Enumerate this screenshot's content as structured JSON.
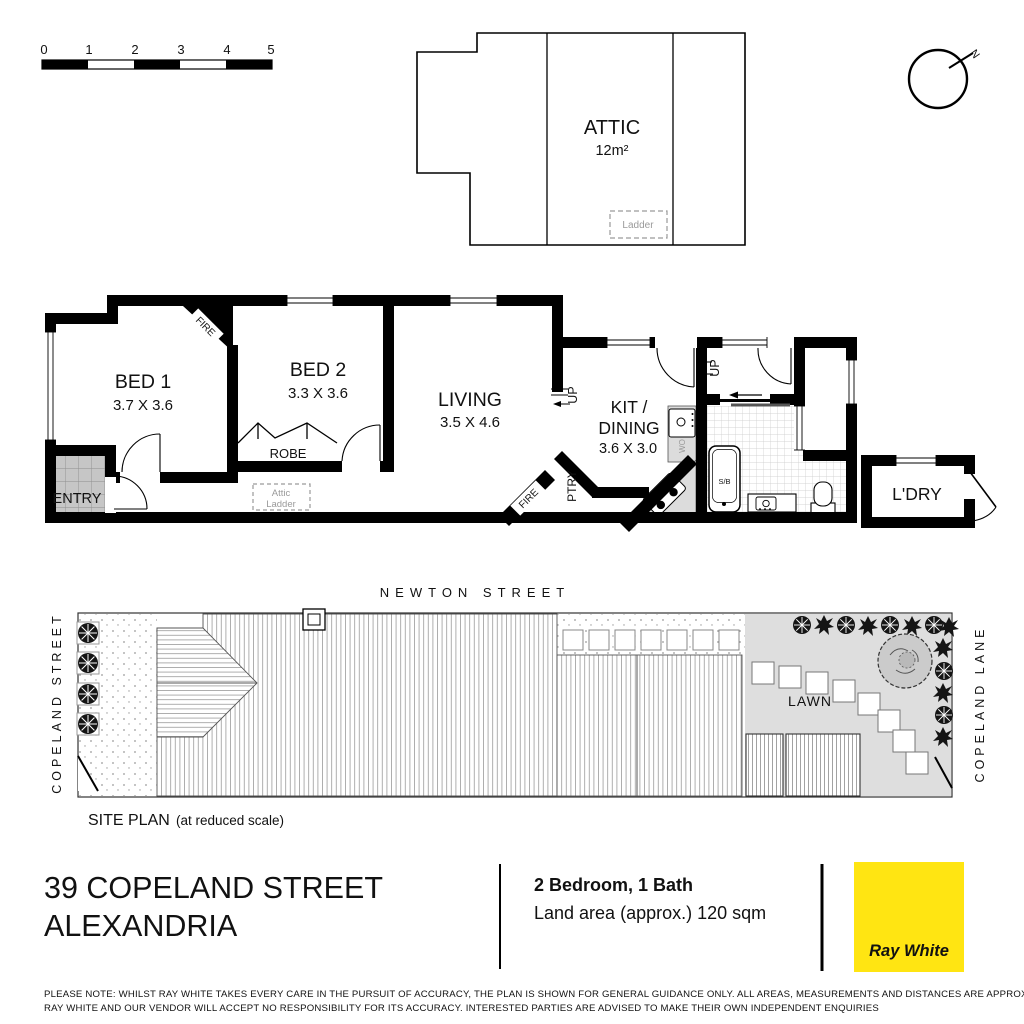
{
  "scale_bar": {
    "t0": "0",
    "t1": "1",
    "t2": "2",
    "t3": "3",
    "t4": "4",
    "t5": "5"
  },
  "attic_plan": {
    "room": "ATTIC",
    "area": "12m²",
    "ladder": "Ladder"
  },
  "compass": {
    "north": "N"
  },
  "floor_plan": {
    "bed1": {
      "name": "BED 1",
      "dims": "3.7 X 3.6"
    },
    "bed2": {
      "name": "BED 2",
      "dims": "3.3 X 3.6"
    },
    "living": {
      "name": "LIVING",
      "dims": "3.5 X 4.6"
    },
    "kitchen": {
      "name_line1": "KIT /",
      "name_line2": "DINING",
      "dims": "3.6 X 3.0"
    },
    "laundry": "L'DRY",
    "entry": "ENTRY",
    "robe": "ROBE",
    "pantry": "PTRY",
    "attic_ladder_line1": "Attic",
    "attic_ladder_line2": "Ladder",
    "fire": "FIRE",
    "up": "UP",
    "shower_bath": "S/B",
    "wall_oven": "WO"
  },
  "site_plan": {
    "street_top": "NEWTON STREET",
    "street_left": "COPELAND STREET",
    "lane_right": "COPELAND LANE",
    "lawn": "LAWN",
    "title": "SITE PLAN",
    "title_note": "(at reduced scale)"
  },
  "footer": {
    "address_line1": "39 COPELAND STREET",
    "address_line2": "ALEXANDRIA",
    "summary": "2 Bedroom, 1 Bath",
    "land_area": "Land area (approx.) 120 sqm",
    "brand": "Ray White"
  },
  "disclaimer": {
    "line1": "PLEASE NOTE: WHILST RAY WHITE TAKES EVERY CARE IN THE PURSUIT OF ACCURACY, THE PLAN IS SHOWN FOR GENERAL GUIDANCE ONLY. ALL AREAS, MEASUREMENTS AND DISTANCES ARE APPROXIMATE AND NOT TO SCALE",
    "line2": "RAY WHITE AND OUR VENDOR WILL ACCEPT NO RESPONSIBILITY FOR ITS ACCURACY. INTERESTED PARTIES ARE ADVISED TO MAKE THEIR OWN INDEPENDENT ENQUIRIES"
  },
  "colors": {
    "brand_yellow": "#FFE512",
    "brand_text": "#4D4D4F"
  }
}
